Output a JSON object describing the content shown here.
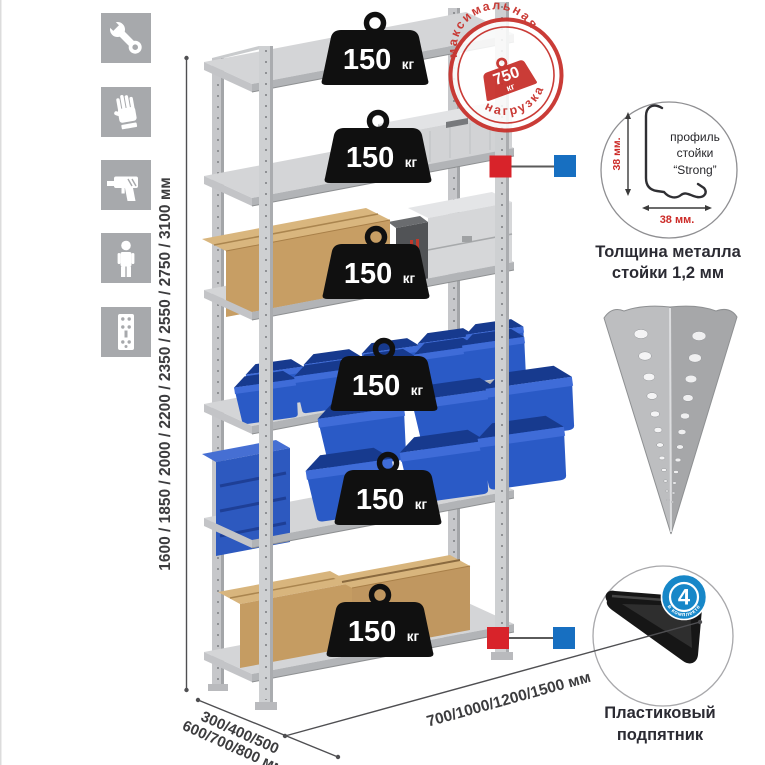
{
  "left_icons": {
    "items": [
      {
        "name": "wrench"
      },
      {
        "name": "gloves"
      },
      {
        "name": "drill"
      },
      {
        "name": "person"
      },
      {
        "name": "perforated-post"
      }
    ]
  },
  "dimensions": {
    "height": "1600 / 1850 / 2000 / 2200 / 2350 / 2550 / 2750 / 3100 мм",
    "depth_line1": "300/400/500",
    "depth_line2": "600/700/800 мм",
    "width": "700/1000/1200/1500 мм"
  },
  "rack": {
    "shelves_count": 6,
    "load_value": "150",
    "load_unit": "кг"
  },
  "stamp": {
    "arc_top": "максимальная",
    "arc_bottom": "нагрузка",
    "value": "750",
    "unit": "кг"
  },
  "profile": {
    "line1": "профиль",
    "line2": "стойки",
    "line3": "“Strong”",
    "dim_vertical": "38 мм.",
    "dim_horizontal": "38 мм.",
    "caption1": "Толщина металла",
    "caption2": "стойки 1,2 мм"
  },
  "foot": {
    "badge_value": "4",
    "badge_arc": "в комплекте",
    "caption1": "Пластиковый",
    "caption2": "подпятник"
  },
  "colors": {
    "stamp_red": "#c8322d",
    "marker_red": "#d8232a",
    "marker_blue": "#176fc1",
    "badge_blue": "#1787c8",
    "bin_blue": "#2a5ac6",
    "metal_gray": "#c9cacd",
    "icon_gray": "#a7a9ac",
    "text_dark": "#2b2b33",
    "dim_text": "#3c3c3e"
  }
}
